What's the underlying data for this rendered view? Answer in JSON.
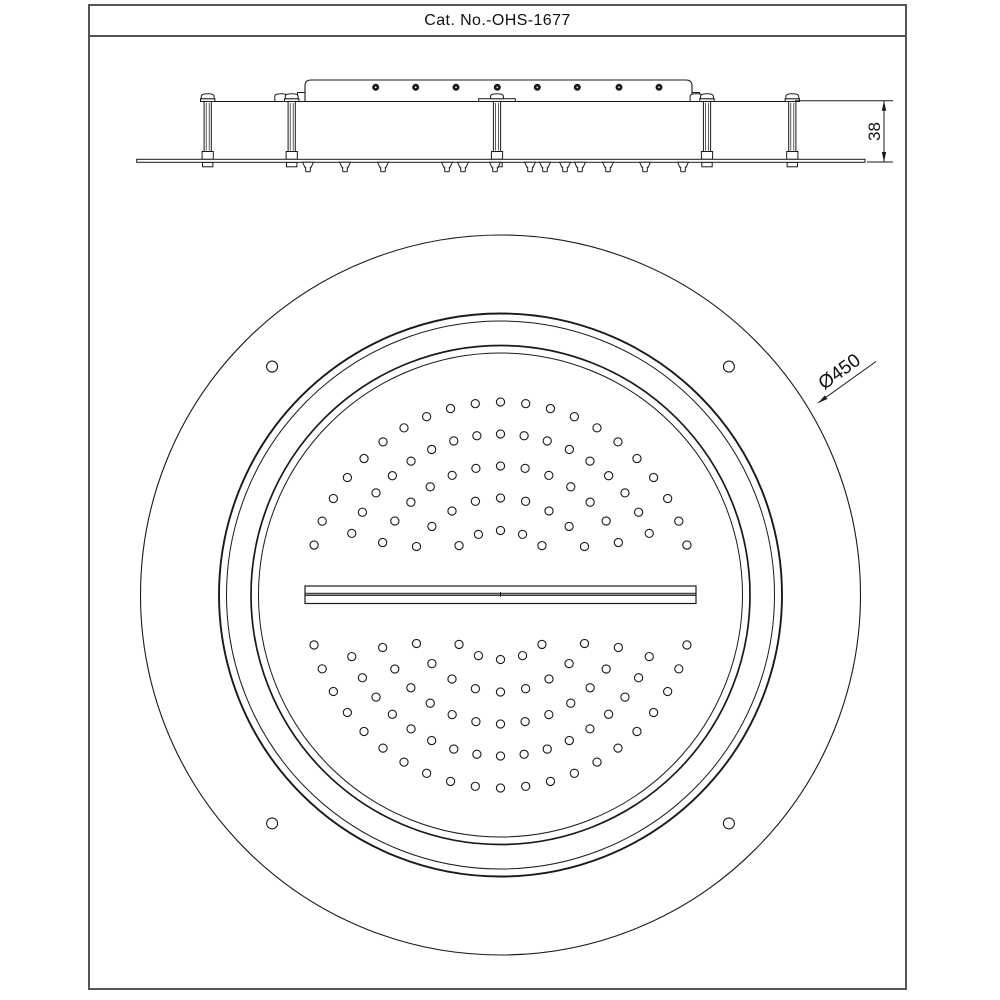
{
  "title": "Cat. No.-OHS-1677",
  "labels": {
    "diameter": "Ø450",
    "height": "38"
  },
  "colors": {
    "line": "#1a1a1a",
    "border": "#555555",
    "slot_fill": "#8a8a8a",
    "white": "#ffffff"
  },
  "side_view": {
    "top_line": {
      "x1": 202,
      "x2": 793,
      "y": 101.5
    },
    "body": {
      "x1": 305,
      "x2": 692,
      "y_top": 80,
      "y_bot": 101.5,
      "corner": 6,
      "tab_top": 92.5,
      "tabs": [
        {
          "x1": 297.5,
          "x2": 305
        },
        {
          "x1": 692,
          "x2": 699.5
        }
      ]
    },
    "inlet_holes": {
      "y": 87.3,
      "r": 3,
      "xs": [
        375.7,
        415.7,
        456,
        497.3,
        537.3,
        577.3,
        619,
        659
      ]
    },
    "posts": {
      "column_halfw": 3.6,
      "col_bot": 151.5,
      "inner_off": 1.5,
      "dome_halfw": 6.4,
      "dome_top": 93.8,
      "collar_halfw": 7.2,
      "collar_top": 98.7,
      "foot_halfw": 5.6,
      "foot_top": 151.5,
      "pad_halfw": 5.2,
      "pad_bot": 166.8,
      "double_offset": -10.5,
      "items": [
        {
          "x": 207.7,
          "cap": "single"
        },
        {
          "x": 291.7,
          "cap": "double"
        },
        {
          "x": 497,
          "cap": "flange",
          "flange_halfw": 18.3
        },
        {
          "x": 707,
          "cap": "double"
        },
        {
          "x": 792.3,
          "cap": "single"
        }
      ]
    },
    "plate": {
      "x1": 136.7,
      "x2": 865,
      "y_top": 159.3,
      "y_bot": 162.3
    },
    "nozzles": {
      "y": 162.3,
      "xs": [
        308,
        345,
        383,
        447,
        463,
        495,
        530,
        545,
        565,
        580,
        608,
        645,
        683
      ]
    },
    "dimension": {
      "x": 884,
      "y1": 100.8,
      "y2": 162,
      "ext_top_x1": 795,
      "ext_bot_x1": 867,
      "ext_x2": 893,
      "text_x": 875.5,
      "text_y": 131.5,
      "font_size": 17
    }
  },
  "plan_view": {
    "cx": 500.5,
    "cy": 595,
    "circles": [
      {
        "r": 360,
        "w": 1.1
      },
      {
        "r": 281.5,
        "w": 1.9
      },
      {
        "r": 274,
        "w": 1.0
      },
      {
        "r": 249.5,
        "w": 1.7
      },
      {
        "r": 242,
        "w": 1.0
      }
    ],
    "bolt_holes": {
      "offset": 228.4,
      "r": 5.5
    },
    "bar": {
      "x1": 305,
      "x2": 696,
      "y_top": 586,
      "y_bot": 603.5,
      "slot_y": 593.2,
      "slot_h": 2.3
    },
    "spray_rings": [
      {
        "r": 193,
        "count": 21,
        "a1": 15,
        "a2": 165
      },
      {
        "r": 161,
        "count": 17,
        "a1": 22.5,
        "a2": 157.5
      },
      {
        "r": 129,
        "count": 13,
        "a1": 24,
        "a2": 156
      },
      {
        "r": 97,
        "count": 9,
        "a1": 30,
        "a2": 150
      },
      {
        "r": 64.5,
        "count": 5,
        "a1": 50,
        "a2": 130
      }
    ],
    "spray_hole_r": 4.1,
    "leader": {
      "tip_x": 818,
      "tip_y": 403,
      "x2": 876,
      "y2": 361.5,
      "text_x": 840,
      "text_y": 372.5,
      "text_angle": -36,
      "font_size": 19
    }
  }
}
